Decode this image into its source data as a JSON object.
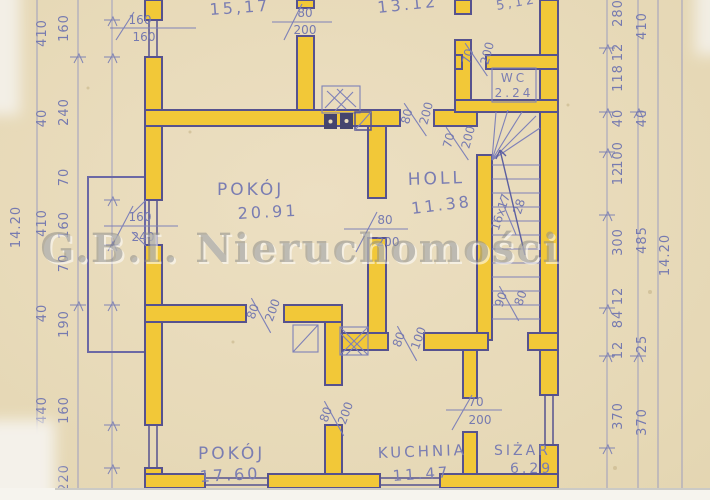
{
  "watermark": "G.B.I. Nieruchomości",
  "rooms": {
    "top_left": {
      "area": "15,17"
    },
    "top_mid": {
      "area": "13.12"
    },
    "top_right": {
      "area": "5,12"
    },
    "wc": {
      "name": "WC",
      "area": "2.24"
    },
    "pokoj_big": {
      "name": "POKÓJ",
      "area": "20.91"
    },
    "holl": {
      "name": "HOLL",
      "area": "11.38"
    },
    "pokoj_small": {
      "name": "POKÓJ",
      "area": "17.60"
    },
    "kuchnia": {
      "name": "KUCHNIA",
      "area": "11.47"
    },
    "spizar": {
      "name": "SIŻAR",
      "area": "6.29"
    }
  },
  "stairs": {
    "steps": "16x17",
    "width": "28"
  },
  "openings": {
    "win_a": {
      "top": "160",
      "bottom": "160"
    },
    "door_a": {
      "top": "80",
      "bottom": "200"
    },
    "door_b": {
      "top": "70",
      "bottom": "200"
    },
    "door_c": {
      "top": "80",
      "bottom": "200"
    },
    "door_d": {
      "top": "70",
      "bottom": "200"
    },
    "win_b": {
      "top": "160",
      "bottom": "240"
    },
    "door_e": {
      "top": "80",
      "bottom": "200"
    },
    "door_f": {
      "top": "80",
      "bottom": "200"
    },
    "door_g": {
      "top": "80",
      "bottom": "100"
    },
    "door_h": {
      "top": "90",
      "bottom": "80"
    },
    "door_i": {
      "top": "80",
      "bottom": "200"
    },
    "door_j": {
      "top": "70",
      "bottom": "200"
    }
  },
  "dims": {
    "left_total": "14.20",
    "left_mid": [
      "410",
      "40",
      "410",
      "40",
      "440"
    ],
    "left_inner": [
      "160",
      "240",
      "70",
      "160",
      "70",
      "190",
      "160",
      "220"
    ],
    "right_inner": [
      "280",
      "12",
      "118",
      "40",
      "100",
      "12",
      "300",
      "12",
      "84",
      "12",
      "370"
    ],
    "right_outer": [
      "410",
      "40",
      "485",
      "25",
      "370"
    ],
    "right_total": "14.20"
  },
  "colors": {
    "paper": "#e9dcbd",
    "wall_highlight": "#f2c838",
    "ink": "#56528f",
    "pencil": "#767ab0",
    "watermark": "#8b8b89"
  }
}
